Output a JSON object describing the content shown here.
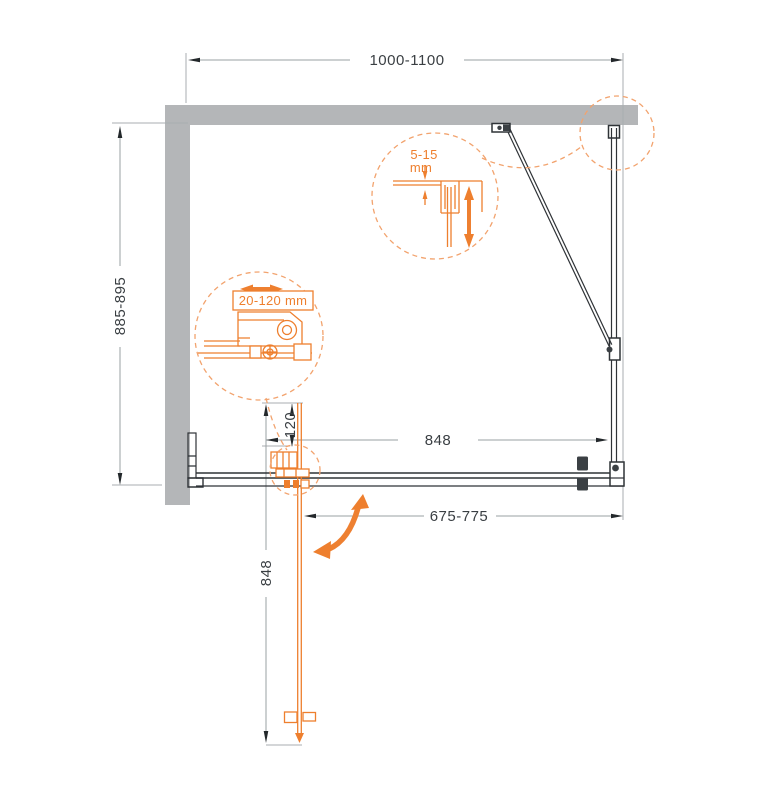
{
  "diagram": {
    "name": "shower-enclosure-installation-plan",
    "dimensions": {
      "top_width": "1000-1100",
      "left_depth": "885-895",
      "door_width": "848",
      "pivot_offset": "120",
      "entry_width": "675-775",
      "open_door_length": "848"
    },
    "details": {
      "top_gap_value": "5-15",
      "top_gap_unit": "mm",
      "wall_profile_adjustment": "20-120 mm"
    },
    "colors": {
      "accent": "#EE7F2E",
      "accent_light": "#F2A36E",
      "wall_gray": "#B4B6B8",
      "line_dark": "#2F3337",
      "dim_gray": "#9AA0A3",
      "text_gray": "#3A3F43"
    }
  }
}
